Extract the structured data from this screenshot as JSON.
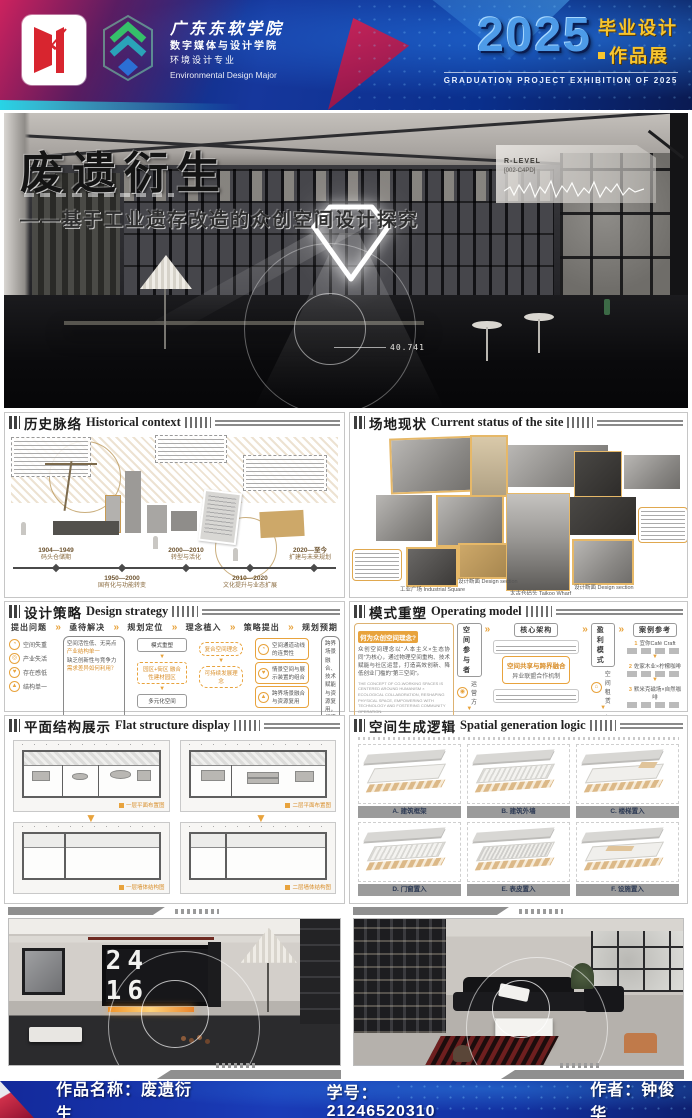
{
  "header": {
    "school_name": "广东东软学院",
    "college": "数字媒体与设计学院",
    "major": "环境设计专业",
    "major_en": "Environmental Design Major",
    "year": "2025",
    "exhibition_cn_1": "毕业设计",
    "exhibition_cn_2": "作品展",
    "exhibition_en": "GRADUATION PROJECT EXHIBITION OF 2025"
  },
  "hero": {
    "title": "废遗衍生",
    "subtitle": "——基于工业遗存改造的众创空间设计探究",
    "badge_title": "R-LEVEL",
    "badge_code": "[002-C4PD]",
    "measure": "40.741"
  },
  "history": {
    "title_cn": "历史脉络",
    "title_en": "Historical context",
    "timeline": [
      {
        "period": "1904—1949",
        "label": "码头仓储期"
      },
      {
        "period": "1950—2000",
        "label": "国有化与功能转变"
      },
      {
        "period": "2000—2010",
        "label": "转型与活化"
      },
      {
        "period": "2010—2020",
        "label": "文化提升与业态扩展"
      },
      {
        "period": "2020—至今",
        "label": "扩建与未来规划"
      }
    ]
  },
  "site": {
    "title_cn": "场地现状",
    "title_en": "Current status of the site",
    "captions": [
      "太古仓码头 Taikoo Wharf",
      "设计断面 Design section",
      "工业广场 Industrial Square",
      "设计断面 Design section"
    ]
  },
  "strategy": {
    "title_cn": "设计策略",
    "title_en": "Design strategy",
    "steps": [
      "提出问题",
      "亟待解决",
      "规划定位",
      "理念植入",
      "策略提出",
      "规划预期"
    ],
    "problems": [
      "空间失重",
      "产业失活",
      "存在感低",
      "结构单一"
    ],
    "analysis": [
      "空间活性低、无亮点",
      "产业结构单一",
      "缺乏创新性与竞争力",
      "需求差异如何利用？"
    ],
    "positioning": [
      "模式重塑",
      "园区+街区 融合性建材园区",
      "多元化空间"
    ],
    "concepts": [
      "复合空间理念",
      "可持续发展理念"
    ],
    "tactics": [
      "空间通道动线的连贯性",
      "情景空间与展示装置的组合",
      "跨界场景融合与资源复用"
    ],
    "expectation": "跨界场景融合、技术赋能与资源复用，打造众创驱动场所的创新模式，以实现长期盈利与客户粘性。"
  },
  "model": {
    "title_cn": "模式重塑",
    "title_en": "Operating model",
    "concept_title": "何为众创空间理念?",
    "concept_body": "众创空间理念以“人本主义×生态协同”为核心，通过物理空间重构、技术赋能与社区运营，打造高效创新、降低创业门槛的“第三空间”。",
    "concept_en": "The concept of co-working spaces is centered around humanism × ecological collaboration, reshaping physical space, empowering with technology and fostering community operation.",
    "columns": [
      "空间参与者",
      "核心架构",
      "盈利模式",
      "案例参考"
    ],
    "participants": [
      "运营方",
      "建材方",
      "设计方",
      "其他群体"
    ],
    "core_center_1": "空间共享与跨界融合",
    "core_center_2": "异业联盟合作机制",
    "profits": [
      "空间租赁",
      "佣金分成",
      "会员体系",
      "线上带动"
    ],
    "cases": [
      "宜你Café Craft",
      "佐家木业×柠檬咖啡",
      "默米克磁场×自然咖啡"
    ]
  },
  "plan": {
    "title_cn": "平面结构展示",
    "title_en": "Flat structure display",
    "captions": [
      "一层平面布置图",
      "二层平面布置图",
      "一层墙体结构图",
      "二层墙体结构图"
    ]
  },
  "logic": {
    "title_cn": "空间生成逻辑",
    "title_en": "Spatial generation logic",
    "items": [
      "A. 建筑框架",
      "B. 建筑外墙",
      "C. 楼梯置入",
      "D. 门窗置入",
      "E. 表皮置入",
      "F. 设施置入"
    ]
  },
  "renders": {
    "clock": "24 16"
  },
  "footer": {
    "work_label": "作品名称：",
    "work_name": "废遗衍生",
    "id_label": "学号：",
    "id_value": "21246520310",
    "author_label": "作者：",
    "author_name": "钟俊华"
  },
  "icons": {
    "chevron": "»",
    "arrow_down": "▼",
    "arrow_right": "▶",
    "person": "◉",
    "clock": "◔",
    "gear": "◎",
    "heart": "♥",
    "triangle": "▲",
    "home": "⌂",
    "percent": "％",
    "member": "♚",
    "spark": "◆"
  },
  "colors": {
    "accent_orange": "#E8A33D",
    "header_blue": "#16379C",
    "year_blue": "#4D9BE8",
    "exhibition_yellow": "#F7C52E"
  }
}
